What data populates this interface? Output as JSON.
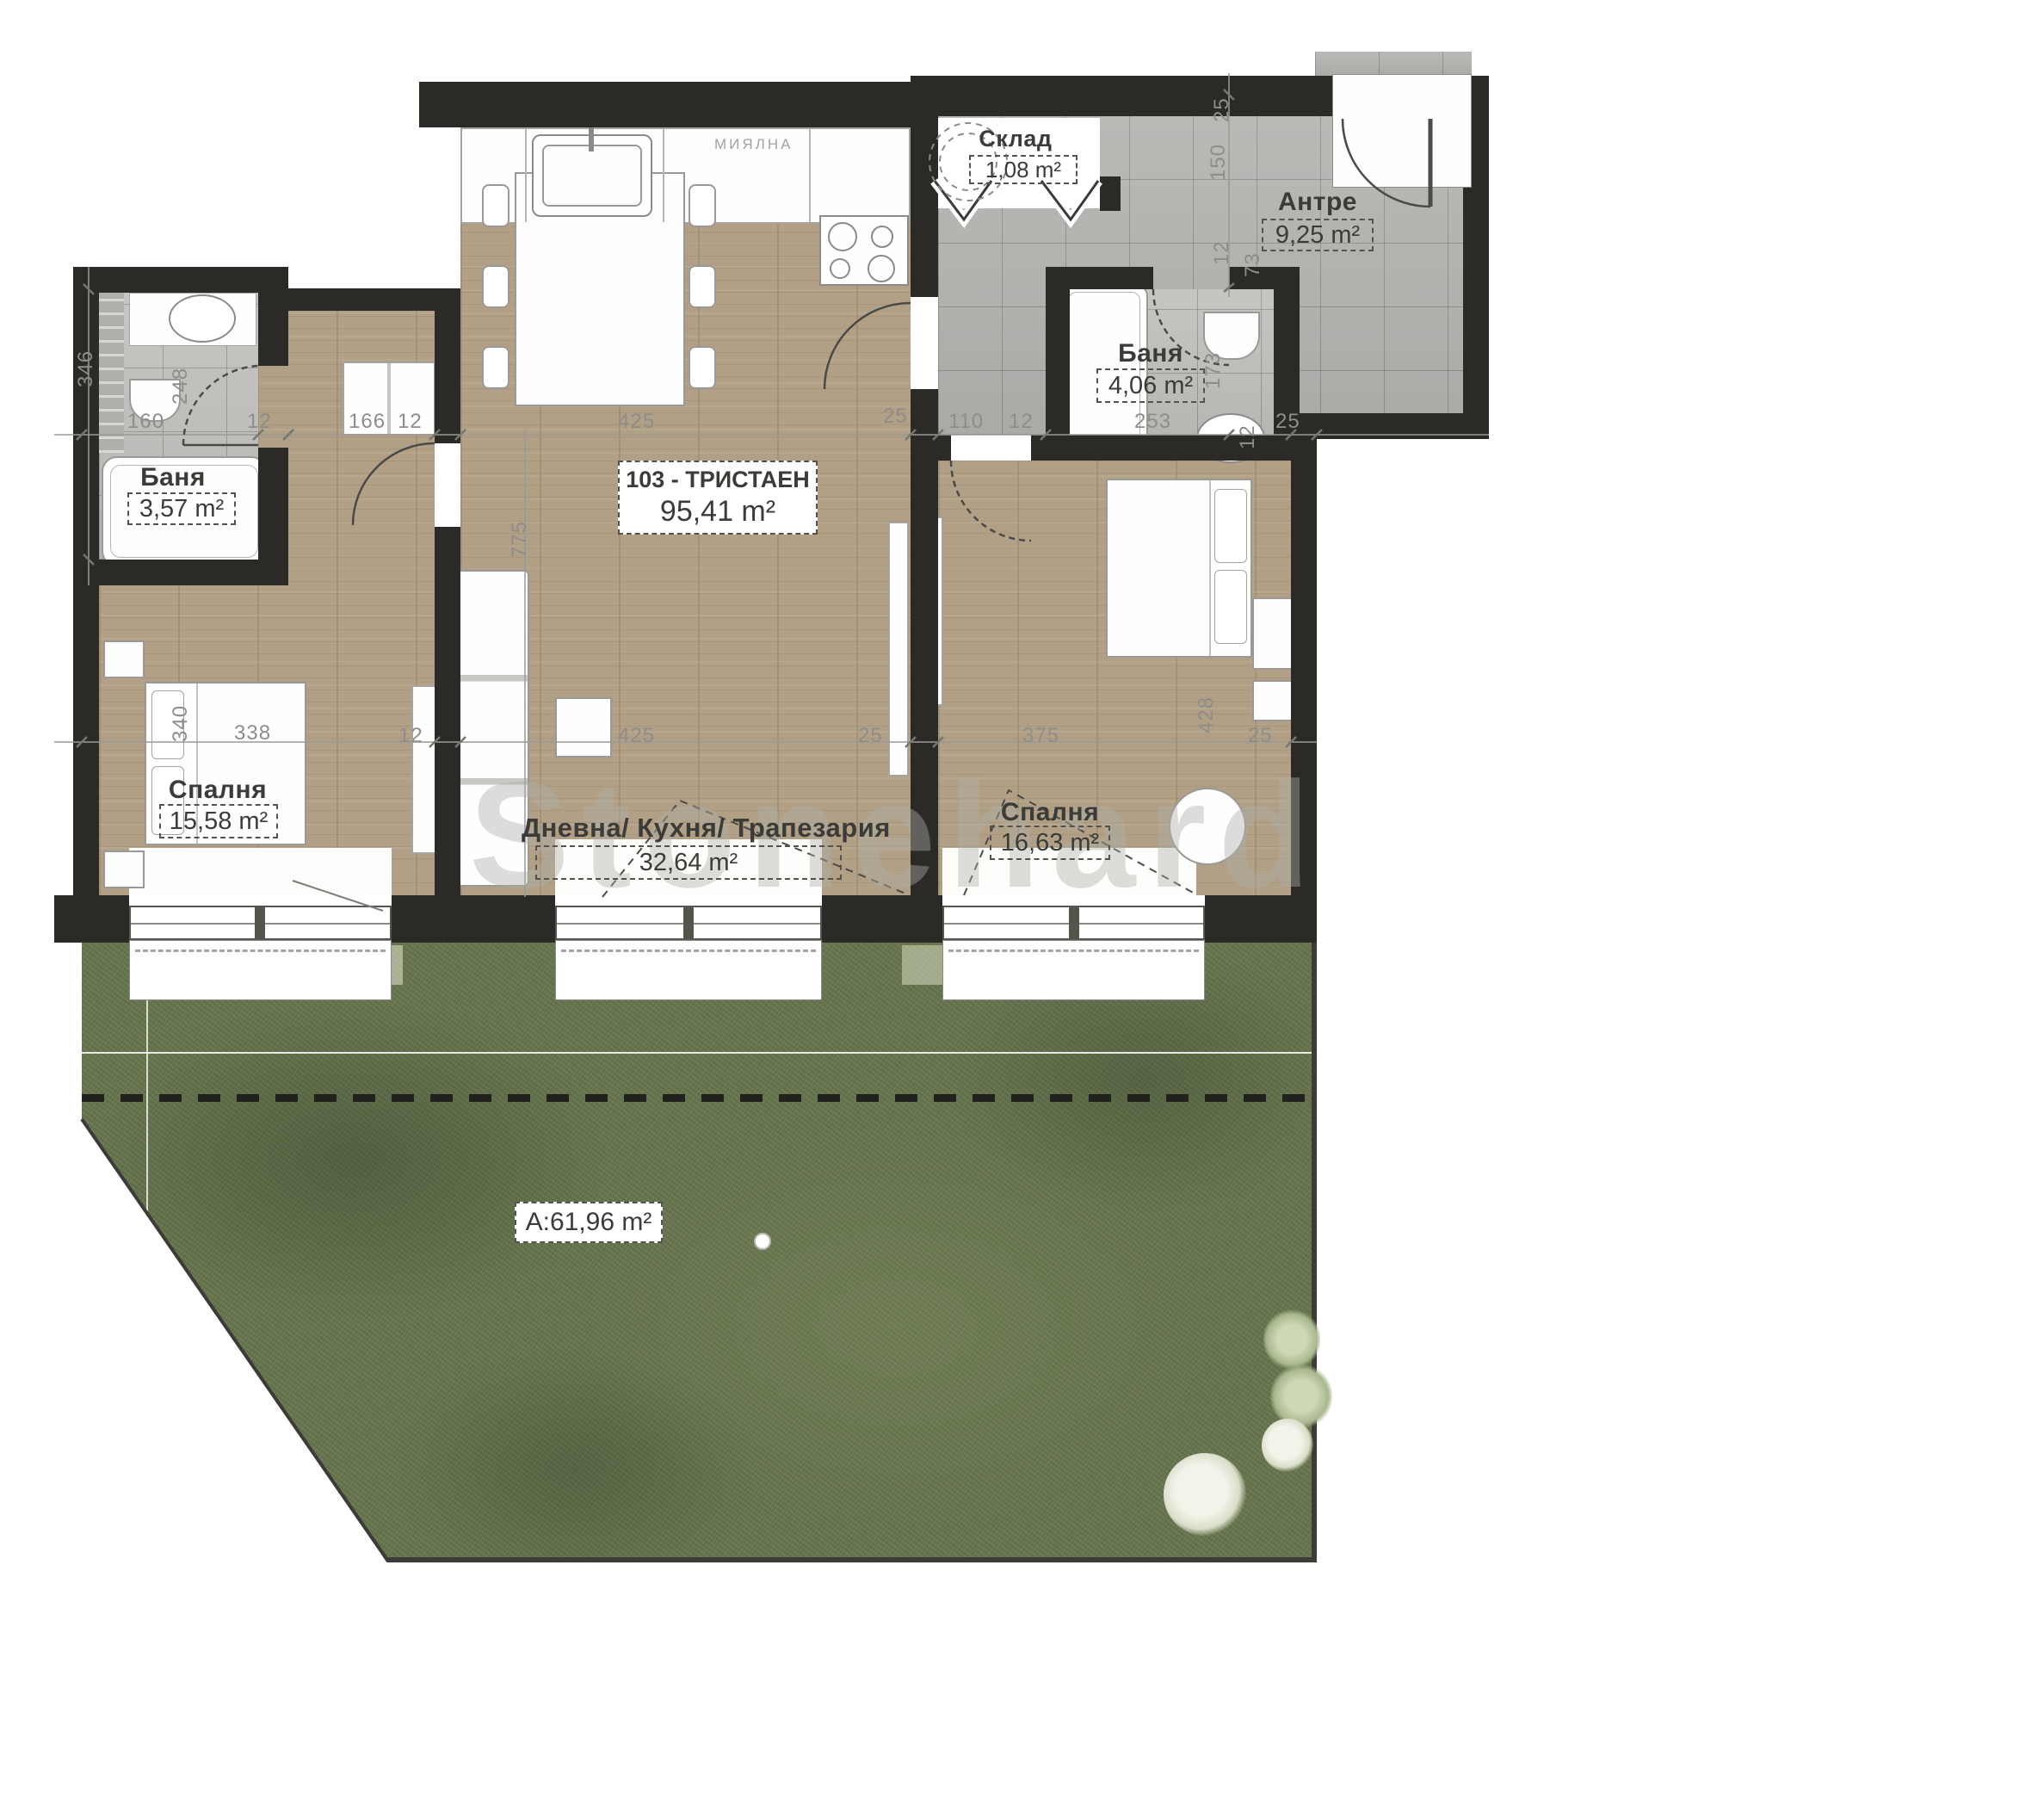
{
  "plan": {
    "unit": {
      "id_label": "103 - ТРИСТАЕН",
      "area": "95,41 m²"
    },
    "rooms": [
      {
        "name": "Склад",
        "area": "1,08 m²"
      },
      {
        "name": "Антре",
        "area": "9,25 m²"
      },
      {
        "name": "Баня",
        "area": "4,06 m²"
      },
      {
        "name": "Баня",
        "area": "3,57 m²"
      },
      {
        "name": "Спалня",
        "area": "15,58 m²"
      },
      {
        "name": "Дневна/ Кухня/ Трапезария",
        "area": "32,64 m²"
      },
      {
        "name": "Спалня",
        "area": "16,63 m²"
      }
    ],
    "garden": {
      "area_label": "A:61,96 m²"
    },
    "appliances": {
      "dishwasher": "МИЯЛНА",
      "laundry": "ПЕРАЛНЯ СУШИЛНЯ"
    },
    "watermark": "Stonehard",
    "dimensions": {
      "top_row": [
        "160",
        "12",
        "166",
        "12",
        "425",
        "25",
        "110",
        "12",
        "253",
        "12",
        "25"
      ],
      "bottom_row": [
        "338",
        "12",
        "425",
        "25",
        "375",
        "25"
      ],
      "vertical": [
        "346",
        "248",
        "340",
        "775",
        "428",
        "173",
        "25",
        "150",
        "12",
        "73"
      ]
    },
    "colors": {
      "wall": "#2b2a26",
      "wood_floor": "#b2a086",
      "tile_floor": "#b5b4b1",
      "grass": "#68764f",
      "dim_text": "#8e8d8a",
      "label_text": "#3b3b38"
    }
  }
}
